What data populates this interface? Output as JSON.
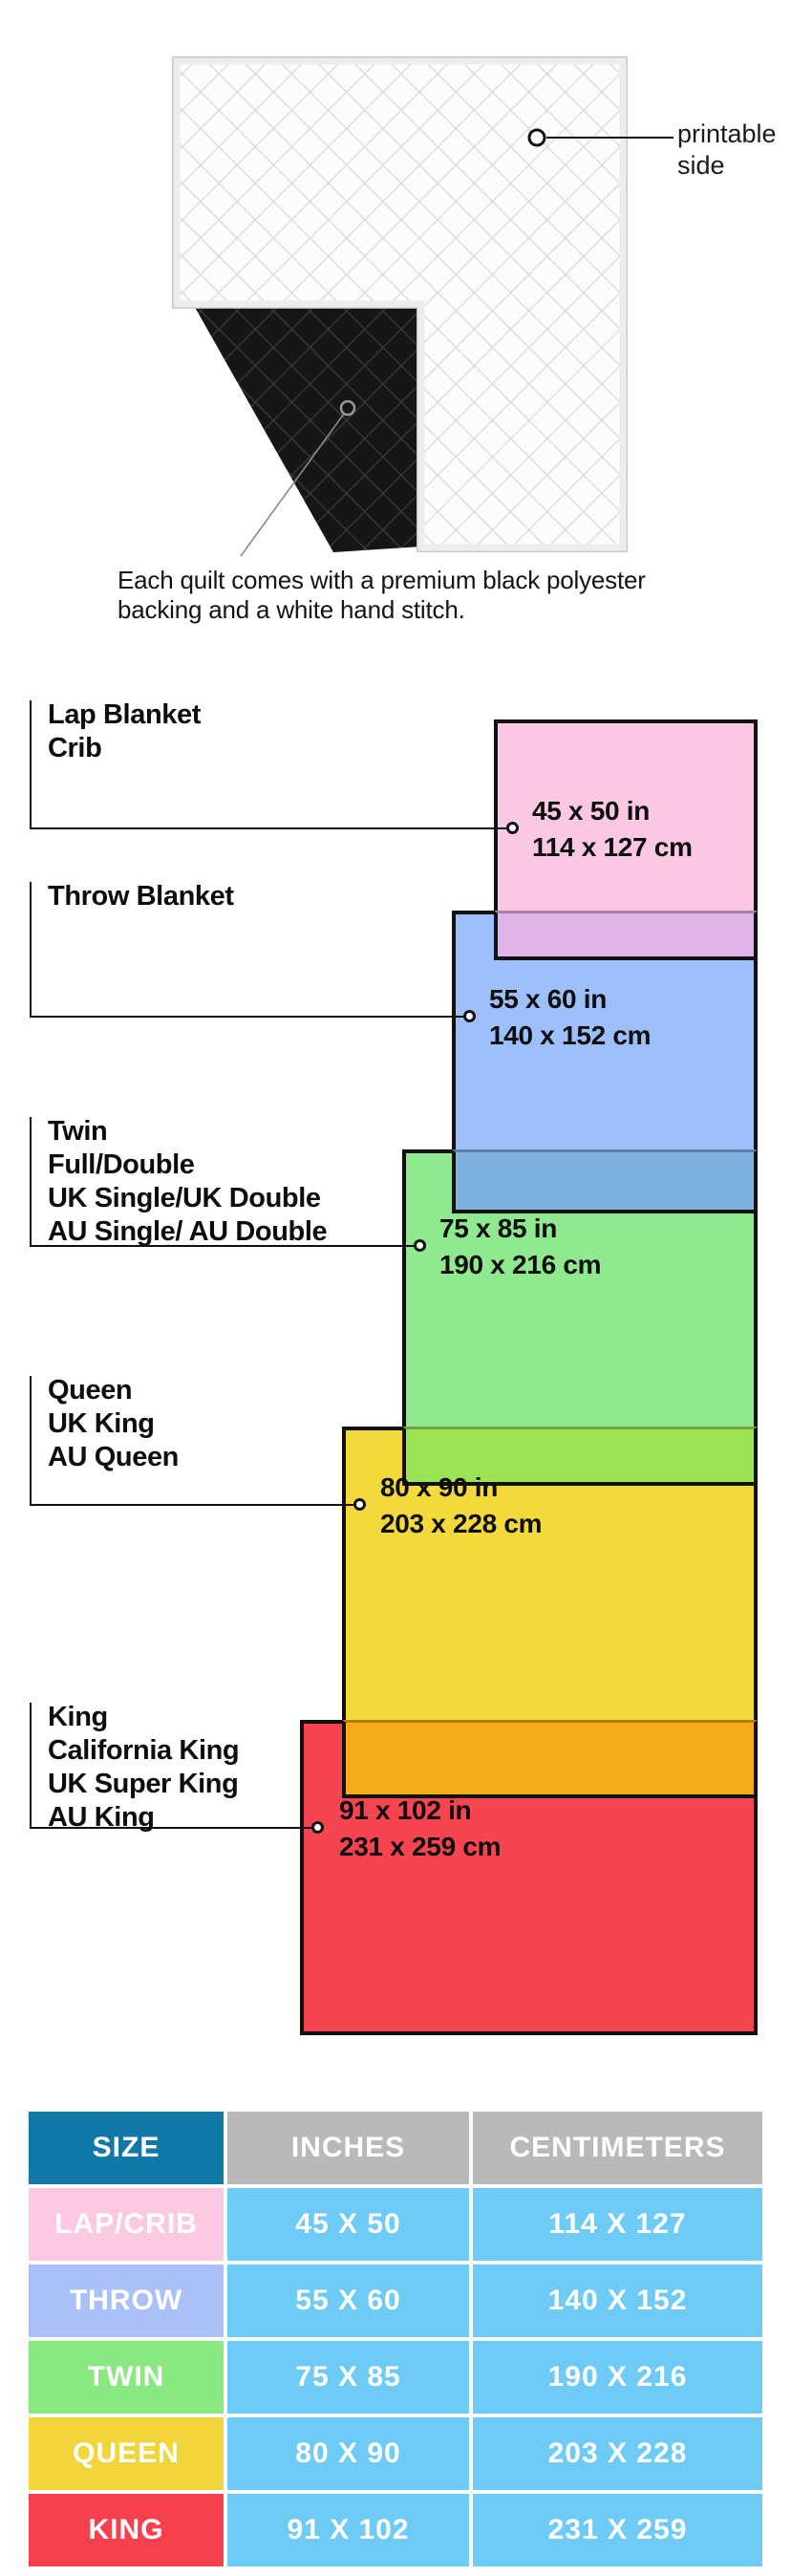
{
  "hero": {
    "printable_label": "printable side",
    "caption_lines": [
      "Each quilt comes with a premium black polyester",
      "backing and a white hand stitch."
    ]
  },
  "diagram": {
    "items": [
      {
        "key": "lap",
        "labels": [
          "Lap Blanket",
          "Crib"
        ],
        "size_in": "45 x 50 in",
        "size_cm": "114 x 127 cm",
        "color": "#FBC8E4",
        "overlap_color": "#E0B4E6"
      },
      {
        "key": "throw",
        "labels": [
          "Throw Blanket"
        ],
        "size_in": "55 x 60 in",
        "size_cm": "140 x 152 cm",
        "color": "#9DBFFA",
        "overlap_color": "#7FB3DF"
      },
      {
        "key": "twin",
        "labels": [
          "Twin",
          "Full/Double",
          "UK Single/UK Double",
          "AU Single/ AU Double"
        ],
        "size_in": "75 x 85 in",
        "size_cm": "190 x 216 cm",
        "color": "#90E88F",
        "overlap_color": "#9DE356"
      },
      {
        "key": "queen",
        "labels": [
          "Queen",
          "UK King",
          "AU Queen"
        ],
        "size_in": "80 x 90 in",
        "size_cm": "203 x 228 cm",
        "color": "#F4D93C",
        "overlap_color": "#F4AC1B"
      },
      {
        "key": "king",
        "labels": [
          "King",
          "California King",
          "UK Super King",
          "AU King"
        ],
        "size_in": "91 x 102 in",
        "size_cm": "231 x 259 cm",
        "color": "#F64450",
        "overlap_color": ""
      }
    ]
  },
  "table": {
    "headers": [
      "SIZE",
      "INCHES",
      "CENTIMETERS"
    ],
    "header_size_bg": "#1179A8",
    "header_other_bg": "#B9B9B9",
    "value_bg": "#6DCBF6",
    "rows": [
      {
        "size": "LAP/CRIB",
        "inches": "45 X 50",
        "cm": "114 X 127",
        "color": "#FBC9E2"
      },
      {
        "size": "THROW",
        "inches": "55 X 60",
        "cm": "140 X 152",
        "color": "#A9C0F8"
      },
      {
        "size": "TWIN",
        "inches": "75 X 85",
        "cm": "190 X 216",
        "color": "#89E880"
      },
      {
        "size": "QUEEN",
        "inches": "80 X 90",
        "cm": "203 X 228",
        "color": "#F2D53A"
      },
      {
        "size": "KING",
        "inches": "91 X 102",
        "cm": "231 X 259",
        "color": "#F4414D"
      }
    ]
  }
}
